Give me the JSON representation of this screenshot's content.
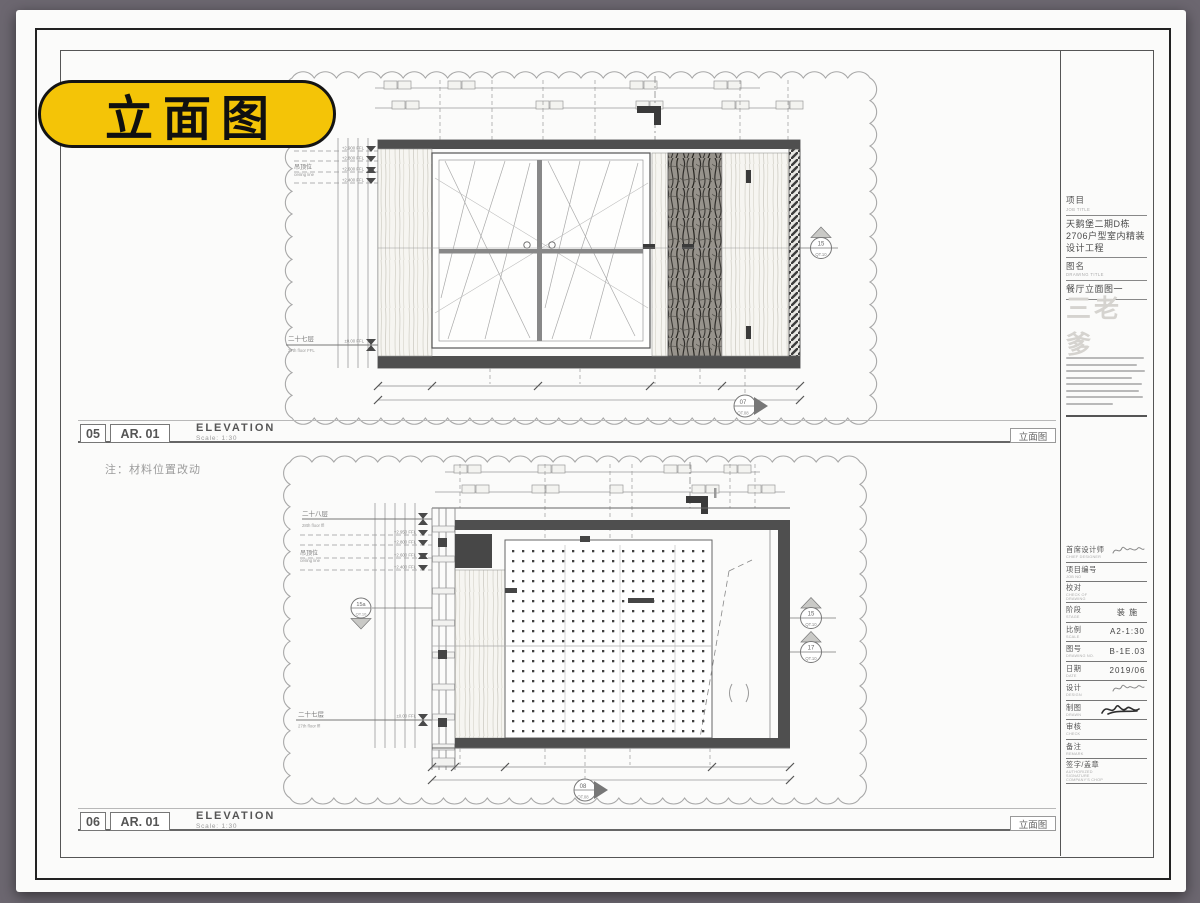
{
  "badge": {
    "label": "立面图"
  },
  "note": "注：材料位置改动",
  "bars": [
    {
      "number": "05",
      "sheet_ref": "AR. 01",
      "title": "ELEVATION",
      "scale": "Scale: 1:30",
      "right_label": "立面图"
    },
    {
      "number": "06",
      "sheet_ref": "AR. 01",
      "title": "ELEVATION",
      "scale": "Scale: 1:30",
      "right_label": "立面图"
    }
  ],
  "elevation_top": {
    "ceiling_label": "吊顶位",
    "ceiling_sub": "ceiling line",
    "floor_label": "二十七层",
    "floor_sub": "27th floor FFL",
    "floor_level": "±0.00 FFL",
    "levels": [
      "+2.900 FFL",
      "+2.800 FFL",
      "+2.600 FFL",
      "+2.400 FFL"
    ],
    "markers": [
      {
        "id": "15",
        "ref": "QT.10"
      },
      {
        "id": "07",
        "ref": "QT.08"
      }
    ]
  },
  "elevation_bottom": {
    "top_floor_label": "二十八层",
    "top_floor_sub": "28th floor ffl",
    "ceiling_label": "吊顶位",
    "ceiling_sub": "ceiling line",
    "floor_label": "二十七层",
    "floor_sub": "27th floor ffl",
    "floor_level": "±0.00 FFL",
    "levels": [
      "+2.950 FFL",
      "+2.800 FFL",
      "+2.600 FFL",
      "+2.400 FFL"
    ],
    "markers": [
      {
        "id": "15a",
        "ref": "QT.10"
      },
      {
        "id": "15",
        "ref": "QT.10"
      },
      {
        "id": "17",
        "ref": "QT.10"
      },
      {
        "id": "08",
        "ref": "QT.08"
      }
    ]
  },
  "title_block": {
    "job_label": "项目",
    "job_sub": "JOB TITLE",
    "job_value": "天鹅堡二期D栋2706户型室内精装设计工程",
    "drawing_label": "图名",
    "drawing_sub": "DRAWING TITLE",
    "drawing_value": "餐厅立面图一",
    "logo": "三老爹",
    "fields": [
      {
        "label": "首席设计师",
        "sub": "CHIEF DESIGNER",
        "value": "",
        "sig": "s1"
      },
      {
        "label": "项目编号",
        "sub": "JOB NO",
        "value": ""
      },
      {
        "label": "校对",
        "sub": "CHECK OF DRAWING",
        "value": ""
      },
      {
        "label": "阶段",
        "sub": "STAGE",
        "value": "装 施"
      },
      {
        "label": "比例",
        "sub": "SCALE",
        "value": "A2-1:30"
      },
      {
        "label": "图号",
        "sub": "DRAWING NO.",
        "value": "B-1E.03"
      },
      {
        "label": "日期",
        "sub": "DATE",
        "value": "2019/06"
      },
      {
        "label": "设计",
        "sub": "DESIGN",
        "value": "",
        "sig": "s1"
      },
      {
        "label": "制图",
        "sub": "DRAWN",
        "value": "",
        "sig": "s2"
      },
      {
        "label": "审核",
        "sub": "CHECK",
        "value": ""
      },
      {
        "label": "备注",
        "sub": "REMARK",
        "value": ""
      },
      {
        "label": "签字/盖章",
        "sub": "AUTHORIZED SIGNATURE",
        "sub2": "COMPANY'S CHOP",
        "value": ""
      }
    ]
  }
}
